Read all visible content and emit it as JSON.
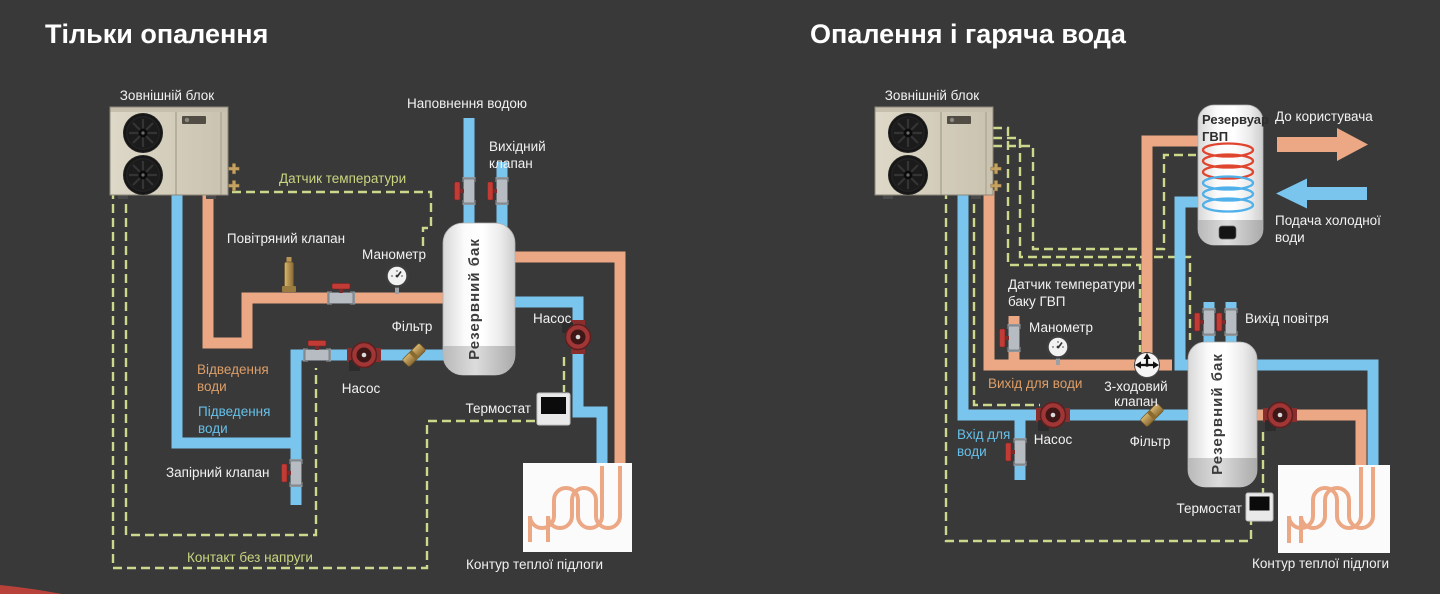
{
  "colors": {
    "background": "#393939",
    "title": "#ffffff",
    "pipe-hot": "#eca884",
    "pipe-cold": "#79c5ee",
    "dashed-line": "#ccd88c",
    "label-light": "#f2f2f2",
    "label-hot": "#dd9e68",
    "label-cold": "#66c0e9",
    "label-olive": "#c9d580",
    "tank-text": "#3c3c3c"
  },
  "left": {
    "title": "Тільки опалення",
    "labels": {
      "outdoor_unit": "Зовнішній блок",
      "water_fill": "Наповнення водою",
      "outlet_valve_lines": [
        "Вихідний",
        "клапан"
      ],
      "temp_sensor": "Датчик температури",
      "air_valve": "Повітряний клапан",
      "manometer": "Манометр",
      "reserve_tank": "Резервний бак",
      "filter": "Фільтр",
      "pump_main": "Насос",
      "pump_floor": "Насос",
      "water_return_lines": [
        "Відведення",
        "води"
      ],
      "water_supply_lines": [
        "Підведення",
        "води"
      ],
      "shutoff_valve": "Запірний клапан",
      "thermostat": "Термостат",
      "dry_contact": "Контакт без напруги",
      "floor_circuit": "Контур теплої підлоги"
    }
  },
  "right": {
    "title": "Опалення і гаряча вода",
    "labels": {
      "outdoor_unit": "Зовнішній блок",
      "dhw_tank_lines": [
        "Резервуар",
        "ГВП"
      ],
      "to_user": "До користувача",
      "cold_water_lines": [
        "Подача холодної",
        "води"
      ],
      "dhw_sensor_lines": [
        "Датчик температури",
        "баку ГВП"
      ],
      "manometer": "Манометр",
      "water_outlet": "Вихід для води",
      "three_way_valve_lines": [
        "3-ходовий",
        "клапан"
      ],
      "water_inlet_lines": [
        "Вхід для",
        "води"
      ],
      "pump_main": "Насос",
      "filter": "Фільтр",
      "air_outlet": "Вихід повітря",
      "reserve_tank": "Резервний бак",
      "thermostat": "Термостат",
      "floor_circuit": "Контур теплої підлоги"
    }
  }
}
